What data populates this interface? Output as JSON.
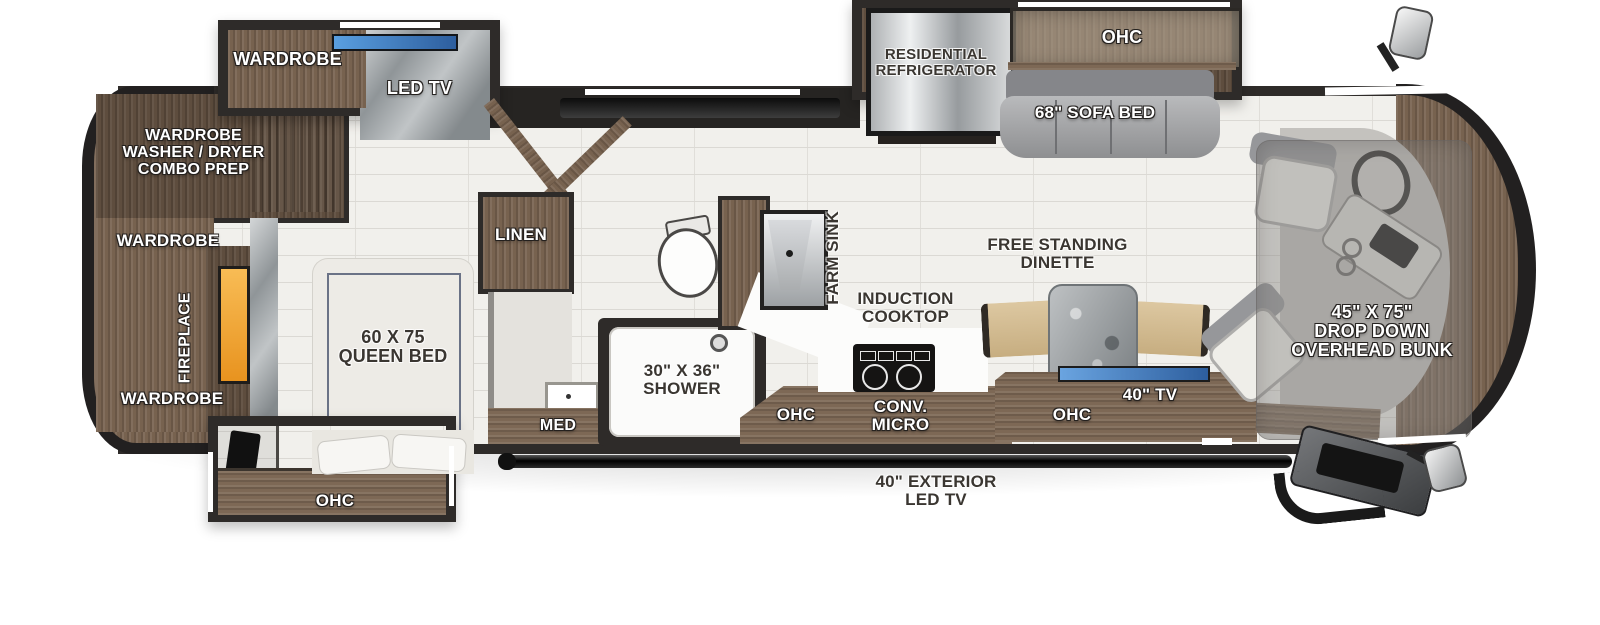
{
  "meta": {
    "title": "Class A motorhome floor plan",
    "canvas_width": 1600,
    "canvas_height": 625
  },
  "colors": {
    "wall": "#2e2b29",
    "wood_dark": "#5e4d3e",
    "wood_mid": "#77624f",
    "wood_light": "#a08b73",
    "bench_wood": "#d8c094",
    "floor_tile": "#f1f0ec",
    "grout": "#dbd9d4",
    "marble": "#9fa5a8",
    "counter_white": "#fcfcfb",
    "fireplace_glow": "#f2a93b",
    "tv_screen_blue": "#3d6fb4",
    "sofa_gray": "#9b9c9e",
    "stainless": "#c9cbcd",
    "bed_white": "#edebe6",
    "bed_trim_navy": "#3e4a66",
    "label_white": "#ffffff",
    "label_dark": "#3a3631"
  },
  "labels": {
    "wardrobe_slide": "WARDROBE",
    "led_tv": "LED TV",
    "washer_dryer": "WARDROBE\nWASHER / DRYER\nCOMBO PREP",
    "wardrobe_mid": "WARDROBE",
    "fireplace": "FIREPLACE",
    "wardrobe_rear": "WARDROBE",
    "queen_bed": "60 X 75\nQUEEN BED",
    "ohc_bedroom": "OHC",
    "linen": "LINEN",
    "med": "MED",
    "shower": "30\" X 36\"\nSHOWER",
    "ohc_bath": "OHC",
    "farm_sink": "FARM SINK",
    "induction_cooktop": "INDUCTION\nCOOKTOP",
    "conv_micro": "CONV.\nMICRO",
    "refrigerator": "RESIDENTIAL\nREFRIGERATOR",
    "ohc_sofa": "OHC",
    "sofa_bed": "68\" SOFA BED",
    "dinette": "FREE STANDING\nDINETTE",
    "ohc_tv": "OHC",
    "tv_40": "40\" TV",
    "overhead_bunk": "45\" X 75\"\nDROP DOWN\nOVERHEAD BUNK",
    "exterior_tv": "40\" EXTERIOR\nLED TV"
  }
}
